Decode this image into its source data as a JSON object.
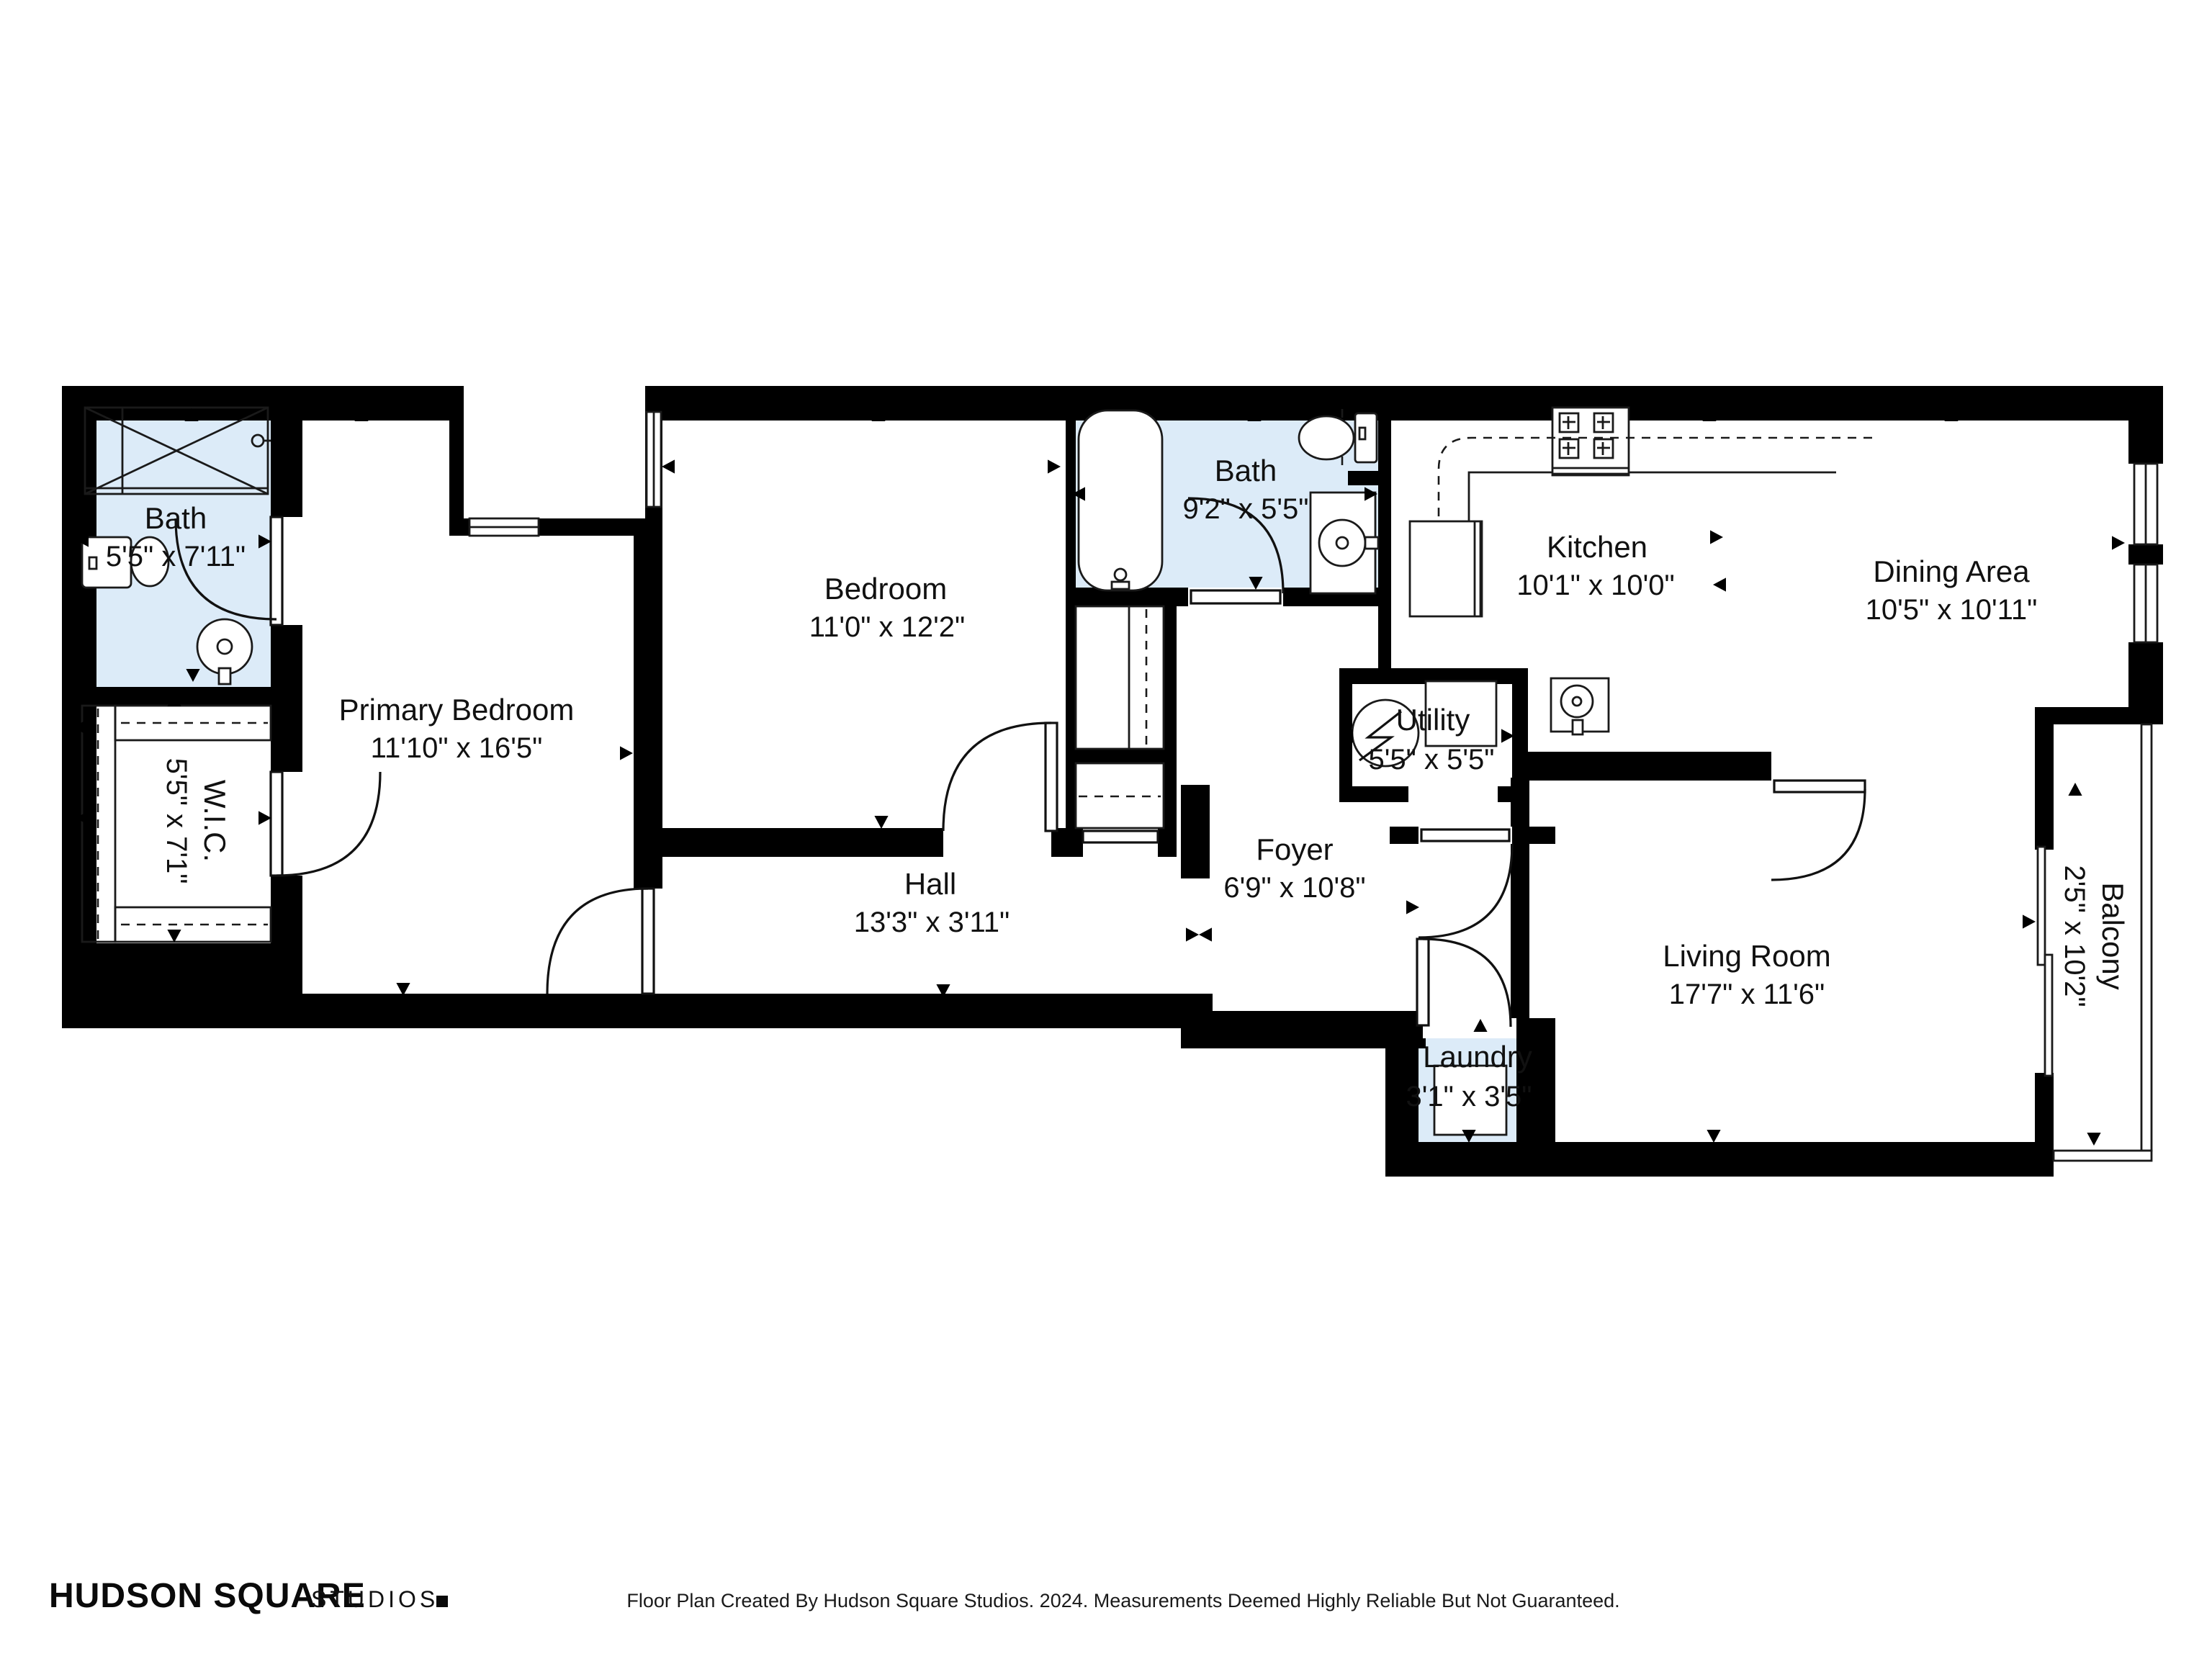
{
  "rooms": {
    "bath1": {
      "name": "Bath",
      "dims": "5'5\" x 7'11\""
    },
    "wic": {
      "name": "W.I.C.",
      "dims": "5'5\" x 7'1\""
    },
    "primary": {
      "name": "Primary Bedroom",
      "dims": "11'10\" x 16'5\""
    },
    "bedroom": {
      "name": "Bedroom",
      "dims": "11'0\" x 12'2\""
    },
    "bath2": {
      "name": "Bath",
      "dims": "9'2\" x 5'5\""
    },
    "hall": {
      "name": "Hall",
      "dims": "13'3\" x 3'11\""
    },
    "foyer": {
      "name": "Foyer",
      "dims": "6'9\" x 10'8\""
    },
    "utility": {
      "name": "Utility",
      "dims": "5'5\" x 5'5\""
    },
    "kitchen": {
      "name": "Kitchen",
      "dims": "10'1\" x 10'0\""
    },
    "dining": {
      "name": "Dining Area",
      "dims": "10'5\" x 10'11\""
    },
    "living": {
      "name": "Living Room",
      "dims": "17'7\" x 11'6\""
    },
    "balcony": {
      "name": "Balcony",
      "dims": "2'5\" x 10'2\""
    },
    "laundry": {
      "name": "Laundry",
      "dims": "3'1\" x 3'5\""
    }
  },
  "footer": {
    "brand_primary": "HUDSON SQUARE",
    "brand_secondary": "STUDIOS",
    "disclaimer": "Floor Plan Created By Hudson Square Studios. 2024. Measurements Deemed Highly Reliable But Not Guaranteed."
  },
  "colors": {
    "wet_room_fill": "#dcebf8",
    "wall": "#000000"
  }
}
